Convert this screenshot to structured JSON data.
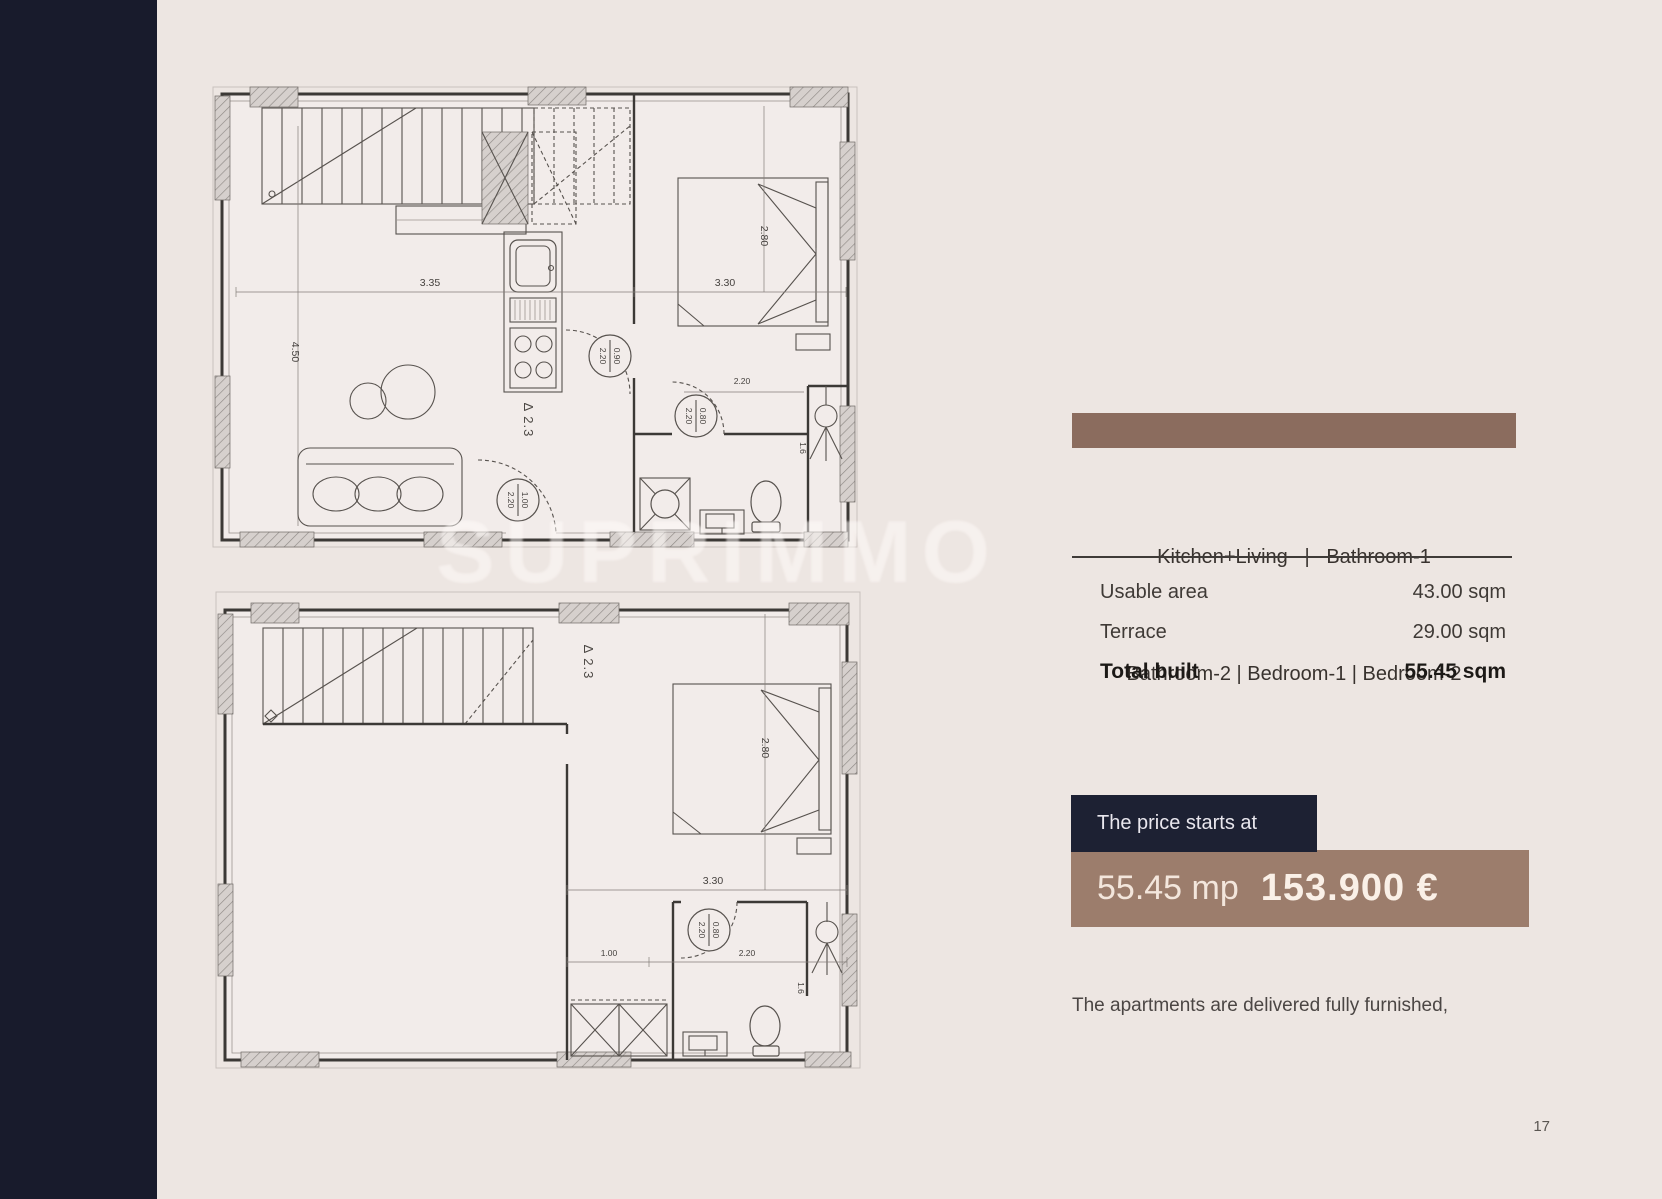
{
  "page": {
    "number": "17",
    "note": "The apartments are delivered fully furnished,",
    "watermark": "SUPRIMMO",
    "colors": {
      "background": "#ede6e2",
      "sidebar": "#181b2c",
      "accent_brown": "#8b6c5e",
      "price_box": "#9c7d6c",
      "price_label_bg": "#1d2133"
    }
  },
  "panel": {
    "rooms_line1": "Kitchen+Living   |   Bathroom-1",
    "rooms_line2": "Bathroom-2 | Bedroom-1 | Bedroom-2",
    "areas": [
      {
        "label": "Usable area",
        "value": "43.00 sqm"
      },
      {
        "label": "Terrace",
        "value": "29.00 sqm"
      },
      {
        "label": "Total built",
        "value": "55.45 sqm"
      }
    ],
    "price": {
      "label": "The price starts at",
      "area": "55.45 mp",
      "amount": "153.900 €"
    }
  },
  "plans": {
    "upper": {
      "level": "Δ 2.3",
      "dims": {
        "living_w": "3.35",
        "bedroom_w": "3.30",
        "living_h": "4.50",
        "bed_h": "2.80",
        "bath_w": "2.20",
        "bath_h": "1.6"
      },
      "doors": {
        "bedroom": [
          "0.90",
          "2.20"
        ],
        "bathroom": [
          "0.80",
          "2.20"
        ],
        "entry": [
          "1.00",
          "2.20"
        ]
      }
    },
    "lower": {
      "level": "Δ 2.3",
      "dims": {
        "bedroom_w": "3.30",
        "bed_h": "2.80",
        "hall_w": "1.00",
        "bath_w": "2.20",
        "bath_h": "1.6"
      },
      "doors": {
        "bathroom": [
          "0.80",
          "2.20"
        ]
      }
    }
  }
}
